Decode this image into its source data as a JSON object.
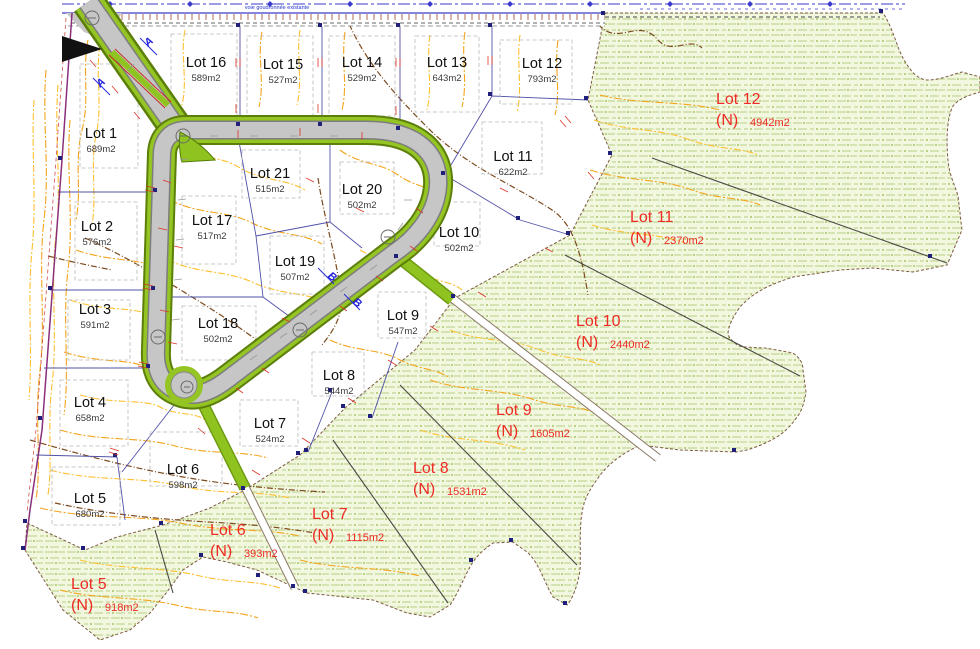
{
  "plan": {
    "road_note": "voie goudronnée existante",
    "section_markers": [
      "A",
      "A",
      "B",
      "B"
    ],
    "lots": [
      {
        "name": "Lot 1",
        "area": "689m2",
        "x": 101,
        "y": 138
      },
      {
        "name": "Lot 2",
        "area": "576m2",
        "x": 97,
        "y": 231
      },
      {
        "name": "Lot 3",
        "area": "591m2",
        "x": 95,
        "y": 314
      },
      {
        "name": "Lot 4",
        "area": "658m2",
        "x": 90,
        "y": 407
      },
      {
        "name": "Lot 5",
        "area": "680m2",
        "x": 90,
        "y": 503
      },
      {
        "name": "Lot 6",
        "area": "598m2",
        "x": 183,
        "y": 474
      },
      {
        "name": "Lot 7",
        "area": "524m2",
        "x": 270,
        "y": 428
      },
      {
        "name": "Lot 8",
        "area": "544m2",
        "x": 339,
        "y": 380
      },
      {
        "name": "Lot 9",
        "area": "547m2",
        "x": 403,
        "y": 320
      },
      {
        "name": "Lot 10",
        "area": "502m2",
        "x": 459,
        "y": 237
      },
      {
        "name": "Lot 11",
        "area": "622m2",
        "x": 513,
        "y": 161
      },
      {
        "name": "Lot 12",
        "area": "793m2",
        "x": 542,
        "y": 68
      },
      {
        "name": "Lot 13",
        "area": "643m2",
        "x": 447,
        "y": 67
      },
      {
        "name": "Lot 14",
        "area": "529m2",
        "x": 362,
        "y": 67
      },
      {
        "name": "Lot 15",
        "area": "527m2",
        "x": 283,
        "y": 69
      },
      {
        "name": "Lot 16",
        "area": "589m2",
        "x": 206,
        "y": 67
      },
      {
        "name": "Lot 17",
        "area": "517m2",
        "x": 212,
        "y": 225
      },
      {
        "name": "Lot 18",
        "area": "502m2",
        "x": 218,
        "y": 328
      },
      {
        "name": "Lot 19",
        "area": "507m2",
        "x": 295,
        "y": 266
      },
      {
        "name": "Lot 20",
        "area": "502m2",
        "x": 362,
        "y": 194
      },
      {
        "name": "Lot 21",
        "area": "515m2",
        "x": 270,
        "y": 178
      }
    ],
    "new_lots": [
      {
        "name": "Lot 12",
        "n": "(N)",
        "area": "4942m2",
        "x": 716,
        "y": 104
      },
      {
        "name": "Lot 11",
        "n": "(N)",
        "area": "2370m2",
        "x": 630,
        "y": 222
      },
      {
        "name": "Lot 10",
        "n": "(N)",
        "area": "2440m2",
        "x": 576,
        "y": 326
      },
      {
        "name": "Lot 9",
        "n": "(N)",
        "area": "1605m2",
        "x": 496,
        "y": 415
      },
      {
        "name": "Lot 8",
        "n": "(N)",
        "area": "1531m2",
        "x": 413,
        "y": 473
      },
      {
        "name": "Lot 7",
        "n": "(N)",
        "area": "1115m2",
        "x": 312,
        "y": 519
      },
      {
        "name": "Lot 6",
        "n": "(N)",
        "area": "393m2",
        "x": 210,
        "y": 535
      },
      {
        "name": "Lot 5",
        "n": "(N)",
        "area": "918m2",
        "x": 71,
        "y": 589
      }
    ],
    "colors": {
      "new_lot_label": "#ee2b24",
      "lot_label": "#0f0f0f",
      "road_fill": "#c6c6c6",
      "verge_green": "#94c523",
      "green_area_bg": "#f1f6dc",
      "contour_orange": "#f3a51b",
      "boundary_blue": "#5050a8"
    }
  }
}
